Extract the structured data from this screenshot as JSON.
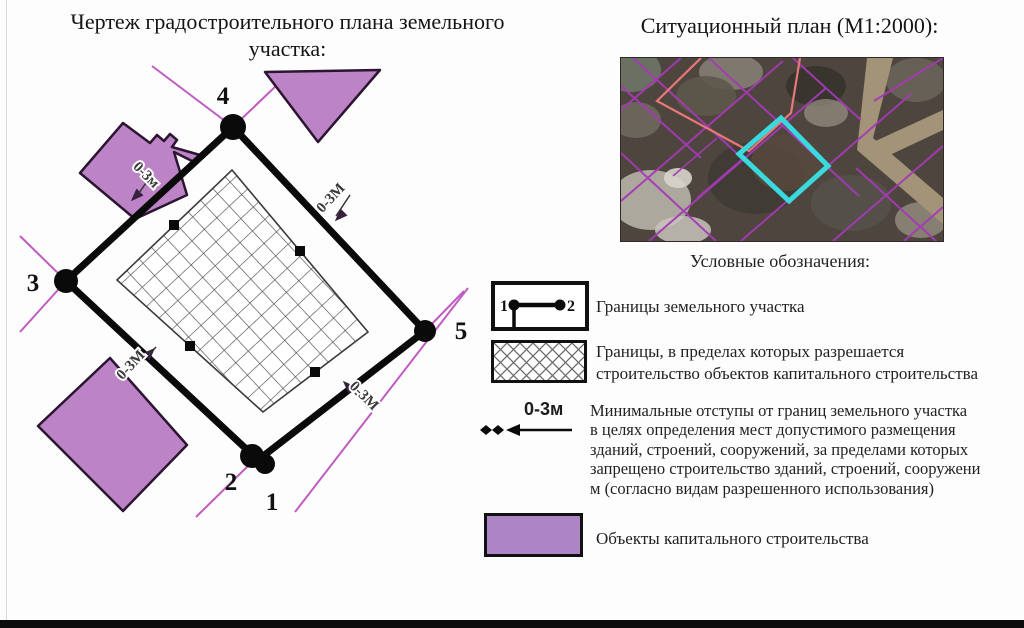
{
  "drawing_panel": {
    "title_line1": "Чертеж градостроительного плана земельного",
    "title_line2": "участка:",
    "vertices": [
      {
        "label": "4"
      },
      {
        "label": "3"
      },
      {
        "label": "5"
      },
      {
        "label": "2"
      },
      {
        "label": "1"
      }
    ],
    "setback_labels": [
      {
        "text": "0-3м",
        "position": "top-left-edge"
      },
      {
        "text": "0-3М",
        "position": "top-right-edge"
      },
      {
        "text": "0-3М",
        "position": "bottom-left-edge"
      },
      {
        "text": "0-3М",
        "position": "bottom-right-edge"
      }
    ]
  },
  "situational_panel": {
    "title": "Ситуационный план (М1:2000):"
  },
  "legend": {
    "heading": "Условные обозначения:",
    "boundary_symbol": {
      "point1": "1",
      "point2": "2"
    },
    "items": [
      {
        "label": "Границы земельного участка"
      },
      {
        "label_line1": "Границы, в пределах которых разрешается",
        "label_line2": "строительство объектов капитального строительства"
      },
      {
        "value": "0-3м",
        "lines": [
          "Минимальные отступы от границ земельного участка",
          "в целях определения мест допустимого размещения",
          "зданий, строений, сооружений, за пределами которых",
          "запрещено строительство зданий, строений, сооружени",
          "м (согласно видам разрешенного использования)"
        ]
      },
      {
        "label": "Объекты капитального строительства"
      }
    ]
  },
  "colors": {
    "building_fill": "#bc84c6",
    "building_outline": "#2b1530",
    "legend_building_fill": "#ad85c7",
    "parcel_line_magenta": "#c05cc0",
    "plot_boundary_black": "#0a0a0a",
    "map_parcel_line": "#a53ab5",
    "map_subject_highlight": "#3ad9dd",
    "map_red_outline": "#e87878",
    "map_ground": "#4e463e",
    "map_road": "#a39379"
  }
}
